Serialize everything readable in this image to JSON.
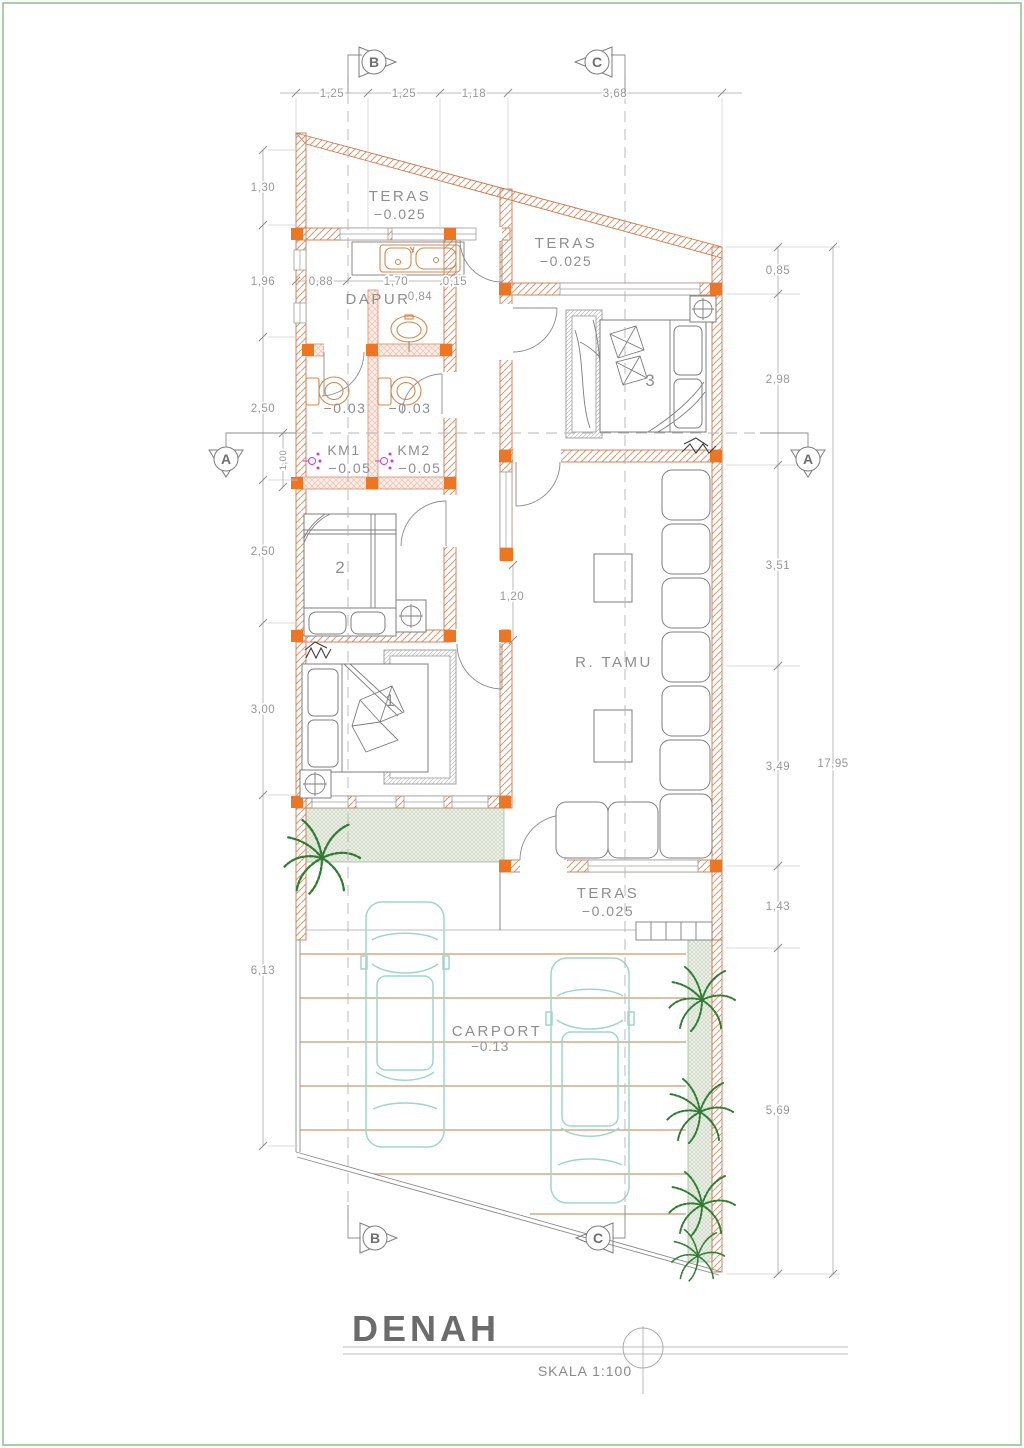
{
  "page": {
    "border_color": "#8cc08c",
    "background": "#ffffff"
  },
  "titleblock": {
    "title": "DENAH",
    "scale": "SKALA 1:100"
  },
  "rooms": {
    "teras_top_left": {
      "name": "TERAS",
      "elevation": "−0.025"
    },
    "teras_top_right": {
      "name": "TERAS",
      "elevation": "−0.025"
    },
    "teras_front": {
      "name": "TERAS",
      "elevation": "−0.025"
    },
    "dapur": {
      "name": "DAPUR"
    },
    "wc_left": {
      "elevation": "−0.03"
    },
    "wc_right": {
      "elevation": "−0.03"
    },
    "km1": {
      "name": "KM1",
      "elevation": "−0.05"
    },
    "km2": {
      "name": "KM2",
      "elevation": "−0.05"
    },
    "bedroom1": {
      "number": "1"
    },
    "bedroom2": {
      "number": "2"
    },
    "bedroom3": {
      "number": "3"
    },
    "r_tamu": {
      "name": "R.  TAMU"
    },
    "carport": {
      "name": "CARPORT",
      "elevation": "−0.13"
    }
  },
  "dimensions": {
    "top": [
      "1,25",
      "1,25",
      "1,18",
      "3,68"
    ],
    "left": [
      "1,30",
      "1,96",
      "2,50",
      "2,50",
      "3,00",
      "6,13"
    ],
    "right": [
      "0,85",
      "2,98",
      "3,51",
      "3,49",
      "1,43",
      "5,69"
    ],
    "overall_right": "17,95",
    "dapur_row": [
      "0,88",
      "1,70",
      "0,15"
    ],
    "dapur_offset": "0,84",
    "km_width": "1,00",
    "hall_opening": "1,20"
  },
  "markers": {
    "a": "A",
    "b": "B",
    "c": "C"
  },
  "colors": {
    "wall_hatch": "#dc9a74",
    "wall_edge": "#c97a4f",
    "column_orange": "#ed7622",
    "fixture_orange": "#cf8a50",
    "shower_magenta": "#d23bd2",
    "car_teal": "#9fd6c9",
    "plant_green": "#2e7d32",
    "grass_hatch": "#b5c7ae",
    "carport_line": "#c49a72",
    "dim_gray": "#a8a8a8",
    "text_gray": "#8e8e8e",
    "border_green": "#8cc08c"
  }
}
